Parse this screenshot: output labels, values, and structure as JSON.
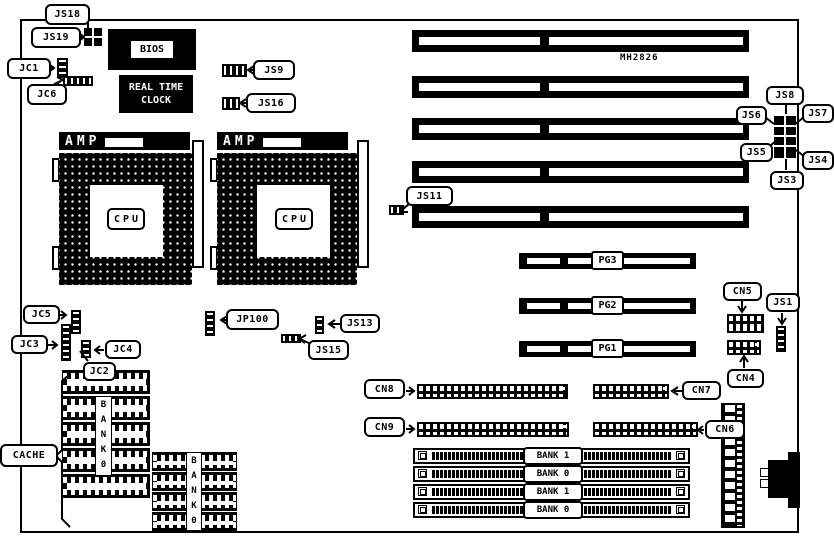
{
  "board": {
    "model": "MH2826"
  },
  "chips": {
    "bios": "BIOS",
    "rtc": "REAL TIME CLOCK",
    "amp": "AMP",
    "cpu": "CPU",
    "cache": "CACHE"
  },
  "jumpers": {
    "js18": "JS18",
    "js19": "JS19",
    "jc1": "JC1",
    "jc6": "JC6",
    "js9": "JS9",
    "js16": "JS16",
    "js8": "JS8",
    "js7": "JS7",
    "js6": "JS6",
    "js5": "JS5",
    "js4": "JS4",
    "js3": "JS3",
    "js11": "JS11",
    "jp100": "JP100",
    "js13": "JS13",
    "js15": "JS15",
    "jc5": "JC5",
    "jc3": "JC3",
    "jc4": "JC4",
    "jc2": "JC2",
    "js1": "JS1"
  },
  "connectors": {
    "cn4": "CN4",
    "cn5": "CN5",
    "cn6": "CN6",
    "cn7": "CN7",
    "cn8": "CN8",
    "cn9": "CN9"
  },
  "slots": {
    "pci": [
      {
        "label": "PG3"
      },
      {
        "label": "PG2"
      },
      {
        "label": "PG1"
      }
    ],
    "simm": [
      {
        "label": "BANK 1"
      },
      {
        "label": "BANK 0"
      },
      {
        "label": "BANK 1"
      },
      {
        "label": "BANK 0"
      }
    ],
    "cache_banks": [
      {
        "label": "BANK0"
      },
      {
        "label": "BANK0"
      }
    ]
  }
}
